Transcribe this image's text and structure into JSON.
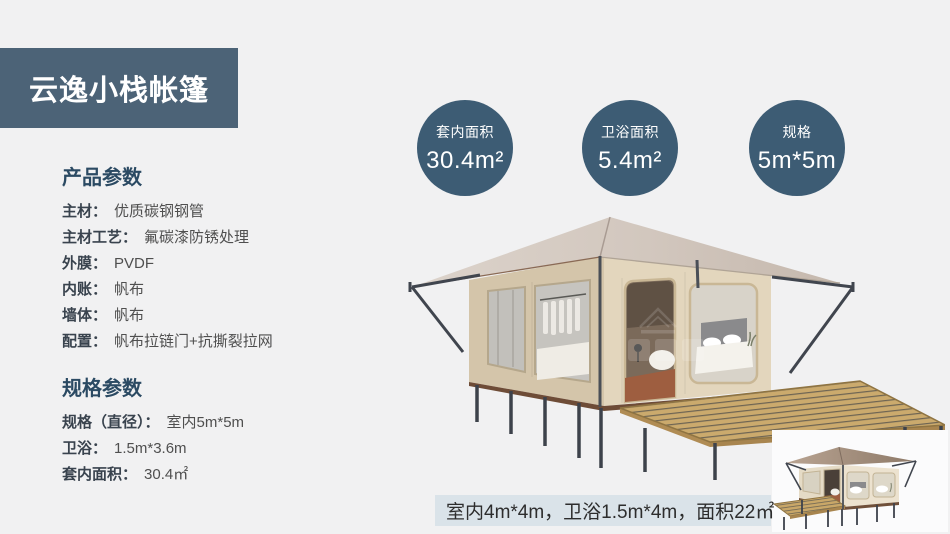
{
  "header": {
    "title": "云逸小栈帐篷",
    "bg_color": "#4c6377"
  },
  "specs": {
    "product": {
      "heading": "产品参数",
      "items": [
        {
          "label": "主材：",
          "value": "优质碳钢钢管"
        },
        {
          "label": "主材工艺：",
          "value": "氟碳漆防锈处理"
        },
        {
          "label": "外膜：",
          "value": "PVDF"
        },
        {
          "label": "内账：",
          "value": "帆布"
        },
        {
          "label": "墙体：",
          "value": "帆布"
        },
        {
          "label": "配置：",
          "value": "帆布拉链门+抗撕裂拉网"
        }
      ]
    },
    "size": {
      "heading": "规格参数",
      "items": [
        {
          "label": "规格（直径）：",
          "value": "室内5m*5m"
        },
        {
          "label": "卫浴：",
          "value": "1.5m*3.6m"
        },
        {
          "label": "套内面积：",
          "value": "30.4㎡"
        }
      ]
    }
  },
  "badges": [
    {
      "label": "套内面积",
      "value": "30.4m²"
    },
    {
      "label": "卫浴面积",
      "value": "5.4m²"
    },
    {
      "label": "规格",
      "value": "5m*5m"
    }
  ],
  "badge_color": "#3d5c74",
  "footnote": {
    "text": "室内4m*4m，卫浴1.5m*4m，面积22㎡",
    "bg_color": "#dae3e9"
  },
  "images": {
    "main_tent": "glamping-tent-3d-render",
    "small_tent": "small-tent-variant-render"
  }
}
